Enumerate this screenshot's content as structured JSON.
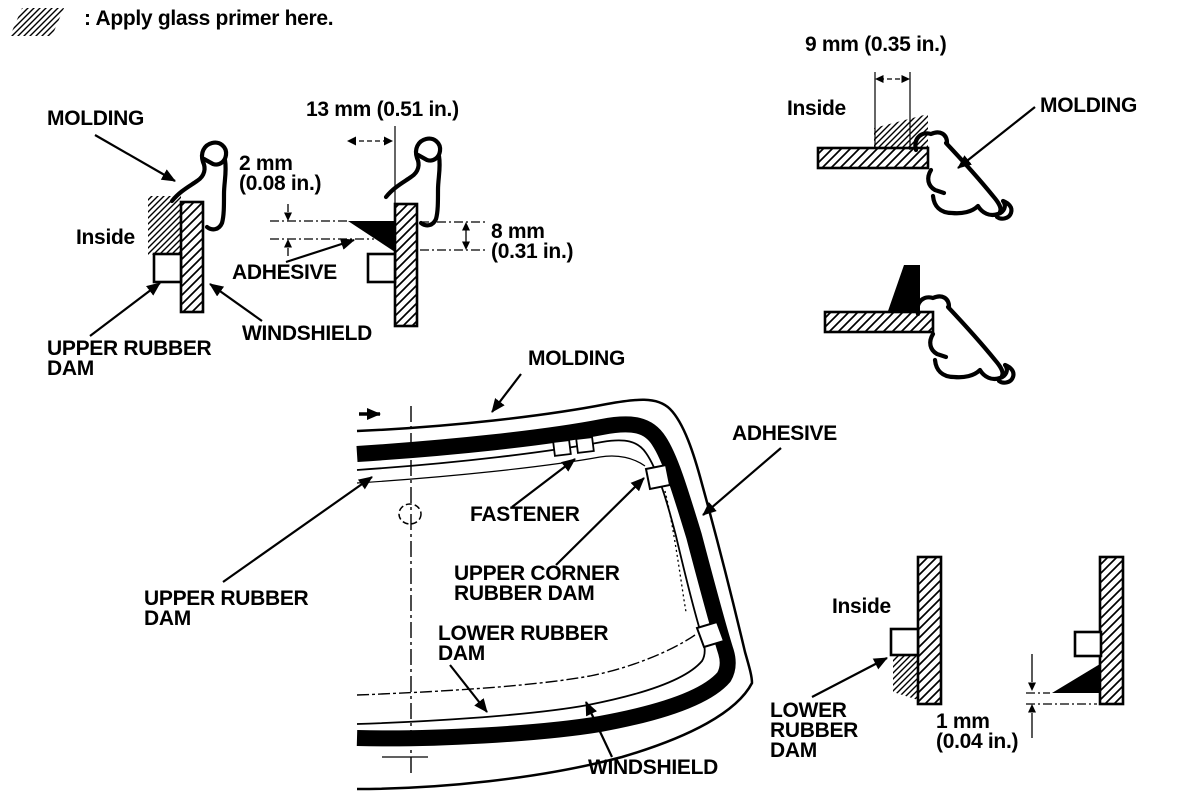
{
  "legend": {
    "label": ": Apply glass primer here."
  },
  "upper_section": {
    "molding": "MOLDING",
    "inside": "Inside",
    "dim_2mm": "2 mm\n(0.08 in.)",
    "dim_13mm": "13 mm (0.51 in.)",
    "adhesive": "ADHESIVE",
    "upper_rubber_dam": "UPPER RUBBER\nDAM",
    "windshield": "WINDSHIELD",
    "dim_8mm": "8 mm\n(0.31 in.)"
  },
  "top_right_section": {
    "dim_9mm": "9 mm (0.35 in.)",
    "inside": "Inside",
    "molding": "MOLDING"
  },
  "overview": {
    "molding": "MOLDING",
    "adhesive": "ADHESIVE",
    "fastener": "FASTENER",
    "upper_corner_rubber_dam": "UPPER CORNER\nRUBBER DAM",
    "upper_rubber_dam": "UPPER RUBBER\nDAM",
    "lower_rubber_dam": "LOWER RUBBER\nDAM",
    "windshield": "WINDSHIELD"
  },
  "bottom_right_section": {
    "inside": "Inside",
    "lower_rubber_dam": "LOWER\nRUBBER\nDAM",
    "dim_1mm": "1 mm\n(0.04 in.)"
  },
  "colors": {
    "ink": "#000000",
    "paper": "#ffffff"
  }
}
